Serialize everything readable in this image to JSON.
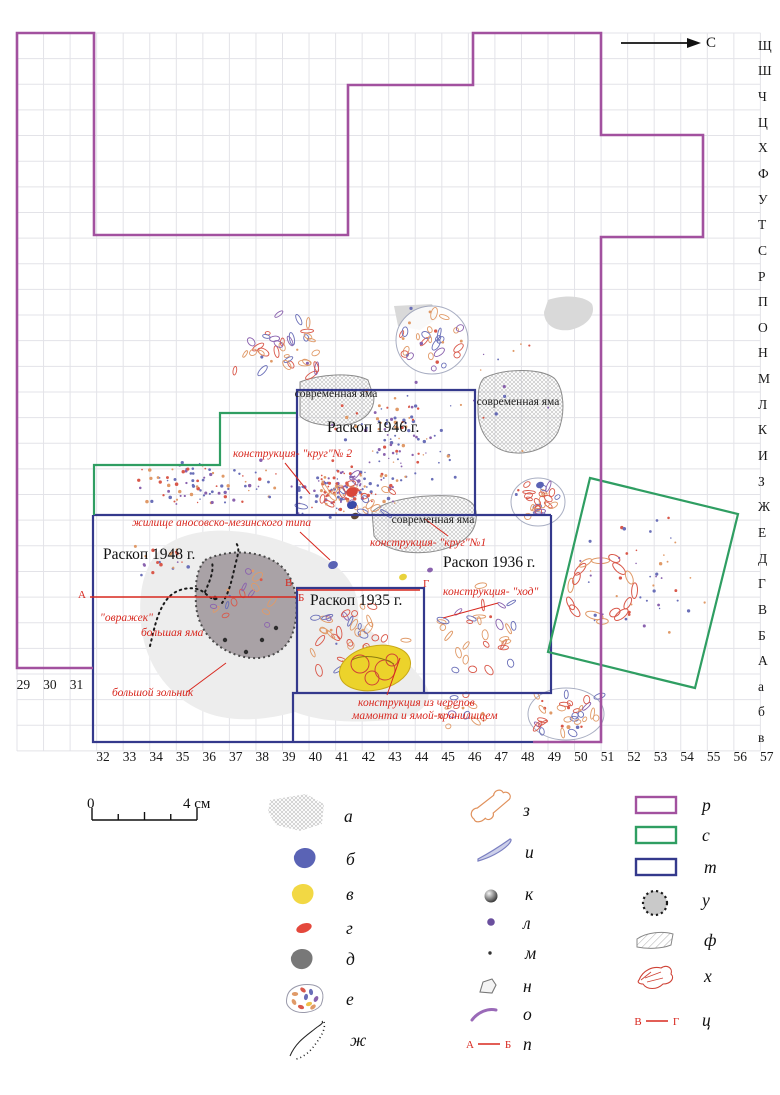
{
  "north": {
    "label": "С"
  },
  "axis": {
    "cols_left": [
      "29",
      "30",
      "31"
    ],
    "cols_main": [
      "32",
      "33",
      "34",
      "35",
      "36",
      "37",
      "38",
      "39",
      "40",
      "41",
      "42",
      "43",
      "44",
      "45",
      "46",
      "47",
      "48",
      "49",
      "50",
      "51",
      "52",
      "53",
      "54",
      "55",
      "56",
      "57"
    ],
    "rows": [
      "Щ",
      "Ш",
      "Ч",
      "Ц",
      "Х",
      "Ф",
      "У",
      "Т",
      "С",
      "Р",
      "П",
      "О",
      "Н",
      "М",
      "Л",
      "К",
      "И",
      "З",
      "Ж",
      "Е",
      "Д",
      "Г",
      "В",
      "Б",
      "А",
      "а",
      "б",
      "в"
    ]
  },
  "colors": {
    "purple": "#a2519f",
    "green": "#2f9e62",
    "navy": "#34398c",
    "red": "#d8281f",
    "grid": "#e3e3e8",
    "ash": "#ededed",
    "pit_fill": "#a9a2a6",
    "pit_border": "#4a4a4a",
    "yellow": "#ecd32b",
    "gray_patch": "#d9d9d9",
    "frag_orange": "#e09a68",
    "frag_red": "#d9584a",
    "frag_blue": "#6a6fb8",
    "frag_violet": "#8a62ae"
  },
  "excavations": [
    {
      "name": "label-raskop-1946",
      "text": "Раскоп 1946 г.",
      "x": 327,
      "y": 419
    },
    {
      "name": "label-raskop-1948",
      "text": "Раскоп 1948 г.",
      "x": 103,
      "y": 546
    },
    {
      "name": "label-raskop-1936",
      "text": "Раскоп 1936 г.",
      "x": 443,
      "y": 554
    },
    {
      "name": "label-raskop-1935",
      "text": "Раскоп 1935 г.",
      "x": 310,
      "y": 592
    }
  ],
  "modern_pits": [
    {
      "name": "label-modern-pit-1",
      "text": "современная яма",
      "cx": 336,
      "y": 388
    },
    {
      "name": "label-modern-pit-2",
      "text": "современная яма",
      "cx": 518,
      "y": 396
    },
    {
      "name": "label-modern-pit-3",
      "text": "современная яма",
      "cx": 433,
      "y": 514
    }
  ],
  "annotations": [
    {
      "name": "annotation-krug-2",
      "text": "конструкция- \"круг\"№ 2",
      "x": 233,
      "y": 448
    },
    {
      "name": "annotation-zhilishche",
      "text": "жилище аносовско-мезинского типа",
      "x": 132,
      "y": 517
    },
    {
      "name": "annotation-krug-1",
      "text": "конструкция- \"круг\"№1",
      "x": 370,
      "y": 537
    },
    {
      "name": "annotation-khod",
      "text": "конструкция- \"ход\"",
      "x": 443,
      "y": 586
    },
    {
      "name": "annotation-ovrazhek",
      "text": "\"овражек\"",
      "x": 100,
      "y": 612
    },
    {
      "name": "annotation-bolshaya-yama",
      "text": "большая яма",
      "x": 141,
      "y": 627
    },
    {
      "name": "annotation-bolshoy-zolnik",
      "text": "большой зольник",
      "x": 112,
      "y": 687
    },
    {
      "name": "annotation-konstrukcia-cherepov-1",
      "text": "конструкция из черепов",
      "x": 358,
      "y": 697
    },
    {
      "name": "annotation-konstrukcia-cherepov-2",
      "text": "мамонта и ямой-хранилищем",
      "x": 352,
      "y": 710
    }
  ],
  "section_letters": [
    {
      "name": "section-letter-a",
      "t": "А",
      "x": 78,
      "y": 589
    },
    {
      "name": "section-letter-b",
      "t": "Б",
      "x": 298,
      "y": 592
    },
    {
      "name": "section-letter-v",
      "t": "В",
      "x": 285,
      "y": 577
    },
    {
      "name": "section-letter-g",
      "t": "Г",
      "x": 423,
      "y": 578
    }
  ],
  "section_lines": [
    "M 90,597 L 296,597",
    "M 297,590 L 420,590"
  ],
  "leader_lines": [
    "M 285,463 L 310,494",
    "M 300,532 L 330,560",
    "M 448,536 L 425,519",
    "M 498,603 L 443,618",
    "M 187,692 L 226,663",
    "M 400,658 L 387,695"
  ],
  "boundaries": [
    {
      "name": "boundary-1946",
      "color": "navy",
      "w": 2.2,
      "d": "M 297,515 L 297,390 L 475,390 L 475,515"
    },
    {
      "name": "boundary-1948-top",
      "color": "navy",
      "w": 2.2,
      "d": "M 93,515 L 551,515"
    },
    {
      "name": "boundary-1948-left-bottom",
      "color": "navy",
      "w": 2.2,
      "d": "M 93,515 L 93,742 L 533,742"
    },
    {
      "name": "boundary-1936",
      "color": "navy",
      "w": 2.2,
      "d": "M 551,515 L 551,693 L 293,693 L 293,742"
    },
    {
      "name": "boundary-1935",
      "color": "navy",
      "w": 2.2,
      "d": "M 297,693 L 297,588 L 424,588 L 424,693"
    },
    {
      "name": "boundary-green-step",
      "color": "green",
      "w": 2.2,
      "d": "M 94,515 L 94,465 L 220,465 L 220,413 L 296,413"
    },
    {
      "name": "boundary-green-tilted",
      "color": "green",
      "w": 2.2,
      "d": "M 590,478 L 738,514 L 695,688 L 548,652 Z"
    },
    {
      "name": "boundary-main-purple",
      "color": "purple",
      "w": 2.6,
      "d": "M 93,668 L 17,668 L 17,33 L 94,33 L 94,235 L 348,235 L 348,85 L 473,85 L 473,33 L 601,33 L 601,135 L 703,135 L 703,237 L 601,237 L 601,742 L 533,742"
    }
  ],
  "blobs": {
    "ash": "M 162,548 C 195,522 255,528 300,548 C 345,562 362,590 358,620 C 380,640 420,668 428,690 C 432,706 415,718 390,720 C 355,723 320,722 295,712 C 260,722 225,722 200,710 C 170,696 148,668 142,632 C 137,598 142,566 162,548 Z",
    "big_pit": "M 205,560 C 230,548 265,550 283,568 C 298,583 300,612 292,635 C 284,655 262,662 240,656 C 215,649 198,630 196,605 C 195,585 196,570 205,560 Z",
    "modern_pit_1": "M 300,382 C 320,374 352,372 368,380 L 374,398 C 374,410 366,420 350,424 C 330,428 308,424 300,416 Z",
    "modern_pit_2": "M 484,378 C 505,368 540,368 554,378 C 564,388 566,412 558,432 C 550,448 528,456 508,452 C 490,448 478,432 478,410 C 478,394 478,384 484,378 Z",
    "modern_pit_3": "M 372,512 C 385,500 420,494 452,496 C 472,498 478,506 476,520 C 474,536 458,548 430,552 C 404,555 382,548 374,536 Z",
    "gray_patch_1": "M 394,306 L 432,304 L 438,318 L 420,330 L 398,326 Z",
    "gray_patch_2": "M 548,300 C 565,294 585,296 592,304 C 596,314 588,326 570,330 C 554,332 544,324 544,312 Z"
  },
  "ravine_paths": [
    "M 150,646 C 155,625 158,610 168,598 C 176,589 190,586 200,590 C 208,594 212,602 218,598",
    "M 222,603 C 230,592 232,578 236,562 C 238,554 240,548 236,543",
    "M 205,592 C 210,580 214,572 212,562"
  ],
  "cluster_outlines": [
    {
      "cx": 538,
      "cy": 502,
      "rx": 27,
      "ry": 24
    },
    {
      "cx": 566,
      "cy": 714,
      "rx": 38,
      "ry": 26
    },
    {
      "cx": 432,
      "cy": 340,
      "rx": 36,
      "ry": 34
    }
  ],
  "scatter": [
    {
      "name": "top-left-bones",
      "kind": "frag",
      "cx": 283,
      "cy": 345,
      "rx": 52,
      "ry": 38,
      "n": 38
    },
    {
      "name": "top-right-ring",
      "kind": "frag-ring",
      "cx": 432,
      "cy": 340,
      "rx": 30,
      "ry": 29,
      "n": 30
    },
    {
      "name": "mid-band",
      "kind": "dots",
      "cx": 205,
      "cy": 483,
      "rx": 85,
      "ry": 26,
      "n": 90
    },
    {
      "name": "krug2-dense",
      "kind": "dots",
      "cx": 345,
      "cy": 492,
      "rx": 58,
      "ry": 26,
      "n": 130
    },
    {
      "name": "krug2-frags",
      "kind": "frag",
      "cx": 345,
      "cy": 495,
      "rx": 55,
      "ry": 22,
      "n": 28
    },
    {
      "name": "inner-1946",
      "kind": "dots",
      "cx": 400,
      "cy": 455,
      "rx": 68,
      "ry": 48,
      "n": 70
    },
    {
      "name": "upper-1946",
      "kind": "dots",
      "cx": 380,
      "cy": 420,
      "rx": 60,
      "ry": 25,
      "n": 30
    },
    {
      "name": "right-mosaic-top",
      "kind": "frag",
      "cx": 538,
      "cy": 502,
      "rx": 24,
      "ry": 20,
      "n": 26
    },
    {
      "name": "skull-ring-green",
      "kind": "ring",
      "cx": 601,
      "cy": 589,
      "r": 30,
      "n": 16
    },
    {
      "name": "green-rect-dots",
      "kind": "dots",
      "cx": 640,
      "cy": 583,
      "rx": 72,
      "ry": 72,
      "n": 45
    },
    {
      "name": "sparse-1936",
      "kind": "frag",
      "cx": 482,
      "cy": 625,
      "rx": 55,
      "ry": 55,
      "n": 30
    },
    {
      "name": "inner-1935",
      "kind": "frag",
      "cx": 355,
      "cy": 640,
      "rx": 55,
      "ry": 40,
      "n": 45
    },
    {
      "name": "bottom-right-mosaic",
      "kind": "frag",
      "cx": 566,
      "cy": 714,
      "rx": 34,
      "ry": 23,
      "n": 34
    },
    {
      "name": "left-1948",
      "kind": "dots",
      "cx": 165,
      "cy": 560,
      "rx": 35,
      "ry": 20,
      "n": 20
    },
    {
      "name": "pit-interior",
      "kind": "frag",
      "cx": 245,
      "cy": 600,
      "rx": 38,
      "ry": 42,
      "n": 18
    },
    {
      "name": "stray",
      "kind": "dots",
      "cx": 470,
      "cy": 380,
      "rx": 115,
      "ry": 85,
      "n": 25
    },
    {
      "name": "bottom-band",
      "kind": "frag",
      "cx": 470,
      "cy": 712,
      "rx": 55,
      "ry": 24,
      "n": 14
    }
  ],
  "special_finds": [
    {
      "x": 333,
      "y": 565,
      "c": "#5a63b5",
      "r": 5
    },
    {
      "x": 403,
      "y": 577,
      "c": "#e8d23c",
      "r": 4
    },
    {
      "x": 352,
      "y": 492,
      "c": "#d9463a",
      "r": 6
    },
    {
      "x": 352,
      "y": 505,
      "c": "#3a49a8",
      "r": 5
    },
    {
      "x": 355,
      "y": 516,
      "c": "#5c4632",
      "r": 4
    },
    {
      "x": 540,
      "y": 485,
      "c": "#5a63b5",
      "r": 4
    },
    {
      "x": 430,
      "y": 570,
      "c": "#8a62ae",
      "r": 3
    }
  ],
  "scale_bar": {
    "zero": "0",
    "four": "4 см"
  },
  "legend": [
    {
      "key": "а",
      "name": "legend-modern-pit-hatch",
      "type": "hatch-patch",
      "sx": 298,
      "sy": 812,
      "lx": 344,
      "ly": 806
    },
    {
      "key": "б",
      "name": "legend-blue-spot",
      "type": "blob",
      "color": "#5a63b5",
      "sx": 305,
      "sy": 858,
      "lx": 346,
      "ly": 849
    },
    {
      "key": "в",
      "name": "legend-yellow-spot",
      "type": "blob",
      "color": "#f2d844",
      "sx": 303,
      "sy": 894,
      "lx": 346,
      "ly": 884
    },
    {
      "key": "г",
      "name": "legend-red-spot",
      "type": "blob-small",
      "color": "#e4483c",
      "sx": 304,
      "sy": 928,
      "lx": 346,
      "ly": 918
    },
    {
      "key": "д",
      "name": "legend-dark-spot",
      "type": "blob",
      "color": "#787878",
      "sx": 302,
      "sy": 959,
      "lx": 346,
      "ly": 949
    },
    {
      "key": "е",
      "name": "legend-mosaic",
      "type": "mosaic",
      "sx": 305,
      "sy": 999,
      "lx": 346,
      "ly": 989
    },
    {
      "key": "ж",
      "name": "legend-ravine",
      "type": "curves",
      "sx": 310,
      "sy": 1040,
      "lx": 350,
      "ly": 1030
    },
    {
      "key": "з",
      "name": "legend-bone",
      "type": "bone",
      "sx": 489,
      "sy": 809,
      "lx": 523,
      "ly": 800
    },
    {
      "key": "и",
      "name": "legend-tusk",
      "type": "tusk",
      "sx": 495,
      "sy": 852,
      "lx": 525,
      "ly": 842
    },
    {
      "key": "к",
      "name": "legend-sphere",
      "type": "sphere",
      "sx": 491,
      "sy": 896,
      "lx": 525,
      "ly": 884
    },
    {
      "key": "л",
      "name": "legend-dot-large",
      "type": "dot-large",
      "sx": 491,
      "sy": 922,
      "lx": 523,
      "ly": 913
    },
    {
      "key": "м",
      "name": "legend-dot-small",
      "type": "dot-small",
      "sx": 490,
      "sy": 953,
      "lx": 525,
      "ly": 943
    },
    {
      "key": "н",
      "name": "legend-stone",
      "type": "poly-outline",
      "sx": 488,
      "sy": 986,
      "lx": 523,
      "ly": 976
    },
    {
      "key": "о",
      "name": "legend-arc",
      "type": "arc-purple",
      "sx": 484,
      "sy": 1014,
      "lx": 523,
      "ly": 1004
    },
    {
      "key": "п",
      "name": "legend-section-ab",
      "type": "section",
      "a": "А",
      "b": "Б",
      "sx": 490,
      "sy": 1044,
      "lx": 523,
      "ly": 1034
    },
    {
      "key": "р",
      "name": "legend-purple-boundary",
      "type": "rect",
      "color": "#a2519f",
      "sx": 656,
      "sy": 805,
      "lx": 702,
      "ly": 795
    },
    {
      "key": "с",
      "name": "legend-green-boundary",
      "type": "rect",
      "color": "#2f9e62",
      "sx": 656,
      "sy": 835,
      "lx": 702,
      "ly": 825
    },
    {
      "key": "т",
      "name": "legend-navy-boundary",
      "type": "rect",
      "color": "#34398c",
      "sx": 656,
      "sy": 867,
      "lx": 704,
      "ly": 857
    },
    {
      "key": "у",
      "name": "legend-big-pit",
      "type": "dotted-circle",
      "sx": 655,
      "sy": 903,
      "lx": 702,
      "ly": 890
    },
    {
      "key": "ф",
      "name": "legend-hatched-area",
      "type": "hatched-poly",
      "sx": 655,
      "sy": 941,
      "lx": 704,
      "ly": 930
    },
    {
      "key": "х",
      "name": "legend-skull",
      "type": "skull",
      "sx": 655,
      "sy": 978,
      "lx": 704,
      "ly": 966
    },
    {
      "key": "ц",
      "name": "legend-section-vg",
      "type": "section",
      "a": "В",
      "b": "Г",
      "sx": 658,
      "sy": 1021,
      "lx": 702,
      "ly": 1010
    }
  ]
}
